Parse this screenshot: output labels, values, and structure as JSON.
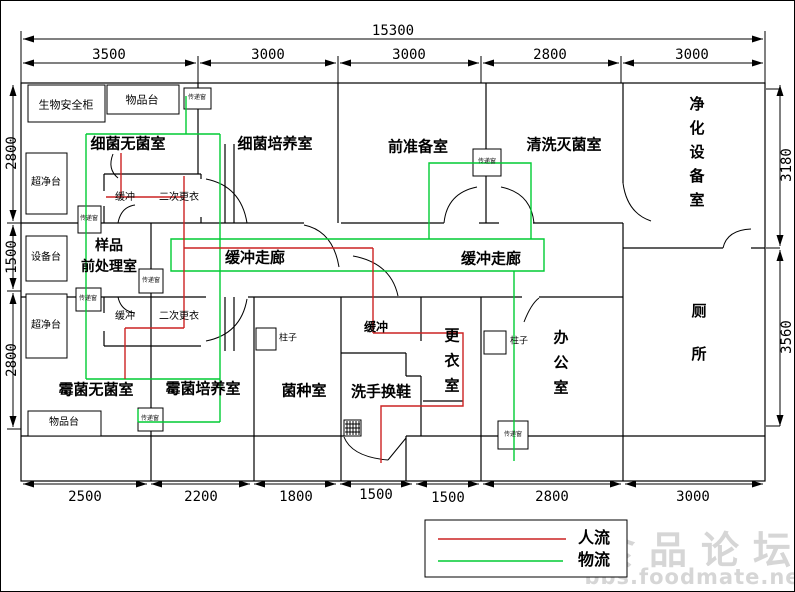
{
  "dims": {
    "total": "15300",
    "top": [
      "3500",
      "3000",
      "3000",
      "2800",
      "3000"
    ],
    "bottom": [
      "2500",
      "2200",
      "1800",
      "1500",
      "1500",
      "2800",
      "3000"
    ],
    "left": [
      "2800",
      "1500",
      "2800"
    ],
    "right": [
      "3180",
      "3560"
    ]
  },
  "rooms": {
    "bacteria_sterile": "细菌无菌室",
    "bacteria_culture": "细菌培养室",
    "pre_prep": "前准备室",
    "wash_sterilize": "清洗灭菌室",
    "purification": "净化设备室",
    "sample_line1": "样品",
    "sample_line2": "前处理室",
    "corridor1": "缓冲走廊",
    "corridor2": "缓冲走廊",
    "toilet": "厕所",
    "mold_sterile": "霉菌无菌室",
    "mold_culture": "霉菌培养室",
    "strain": "菌种室",
    "wash_shoes": "洗手换鞋",
    "changing": "更衣室",
    "office": "办公室"
  },
  "features": {
    "bio_cabinet": "生物安全柜",
    "items_table": "物品台",
    "clean_bench": "超净台",
    "equip_table": "设备台",
    "buffer": "缓冲",
    "second_change": "二次更衣",
    "buffer_center": "缓冲",
    "pillar": "柱子",
    "pass_window": "传递窗"
  },
  "legend": {
    "people": "人流",
    "material": "物流"
  },
  "watermark": {
    "line1": "食品论坛",
    "line2": "bbs.foodmate.net"
  },
  "colors": {
    "people_flow": "#cc2222",
    "material_flow": "#00cc33",
    "watermark": "#d6d6d6",
    "wall": "#000000"
  }
}
